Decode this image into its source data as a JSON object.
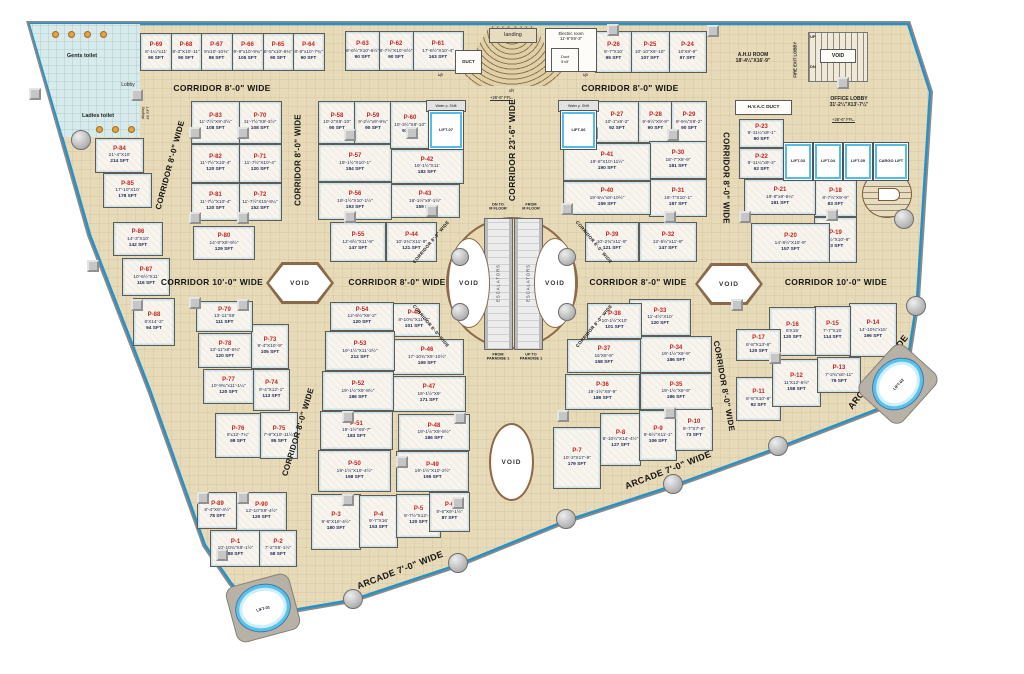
{
  "colors": {
    "floor": "#e7dab8",
    "outline_blue": "#2792c8",
    "unit_fill": "#f8f4ee",
    "unit_label_red": "#c22621",
    "unit_label_navy": "#1b2a56",
    "void_border": "#8a6a4a",
    "toilet_fill": "#d7ebec",
    "lift_blue": "#54bce6"
  },
  "rooms": {
    "gents_toilet": "Gents toilet",
    "ladies_toilet": "Ladies toilet",
    "lobby": "Lobby",
    "display": "display\n46 SFT",
    "duct": "DUCT",
    "landing": "landing",
    "electric_room": "Electric room\n11'-9\"X9'-3\"",
    "duct_small": "Duct\n5'x5'",
    "ahu_room": "A.H.U ROOM\n18'-4¼\"X16'-9\"",
    "fire_exit_lobby": "FIRE EXIT LOBBY",
    "stair_void": "VOID",
    "up": "UP",
    "dn": "DN",
    "up_small": "up",
    "dn_small": "dn",
    "office_lobby": "OFFICE LOBBY\n31'-2¼\"X13'-7¼\"",
    "ffl": "+26'-6\" FFL.",
    "hvac_duct": "H.V.A.C DUCT",
    "water_shaft": "Water p. Shift"
  },
  "escalators": {
    "label": "ESCALATORS",
    "tl": "DN TO\nM FLOOR",
    "tr": "FROM\nM FLOOR",
    "bl": "FROM\nPARADISE 1",
    "br": "UP TO\nPARADISE 1"
  },
  "corridor_labels": [
    {
      "t": "CORRIDOR 8'-0\" WIDE",
      "x": 222,
      "y": 88,
      "r": 0,
      "s": 8.5
    },
    {
      "t": "CORRIDOR 8'-0\" WIDE",
      "x": 630,
      "y": 88,
      "r": 0,
      "s": 8.5
    },
    {
      "t": "CORRIDOR 8'-0\" WIDE",
      "x": 170,
      "y": 165,
      "r": -75,
      "s": 8
    },
    {
      "t": "CORRIDOR 8'-0\" WIDE",
      "x": 298,
      "y": 160,
      "r": -90,
      "s": 8
    },
    {
      "t": "CORRIDOR 23'-6\" WIDE",
      "x": 512,
      "y": 150,
      "r": -90,
      "s": 8.5
    },
    {
      "t": "CORRIDOR 8'-0\" WIDE",
      "x": 726,
      "y": 178,
      "r": 90,
      "s": 8
    },
    {
      "t": "CORRIDOR 10'-0\" WIDE",
      "x": 212,
      "y": 282,
      "r": 0,
      "s": 8.5
    },
    {
      "t": "CORRIDOR 8'-0\" WIDE",
      "x": 397,
      "y": 282,
      "r": 0,
      "s": 8.5
    },
    {
      "t": "CORRIDOR 8'-0\" WIDE",
      "x": 638,
      "y": 282,
      "r": 0,
      "s": 8.5
    },
    {
      "t": "CORRIDOR 10'-0\" WIDE",
      "x": 836,
      "y": 282,
      "r": 0,
      "s": 8.5
    },
    {
      "t": "CORRIDOR 8'-0\" WIDE",
      "x": 298,
      "y": 432,
      "r": -73,
      "s": 8
    },
    {
      "t": "CORRIDOR 8'-0\" WIDE",
      "x": 724,
      "y": 386,
      "r": 80,
      "s": 8
    },
    {
      "t": "ARCADE 7'-0\" WIDE",
      "x": 400,
      "y": 570,
      "r": -21,
      "s": 9
    },
    {
      "t": "ARCADE 7'-0\" WIDE",
      "x": 668,
      "y": 470,
      "r": -21,
      "s": 9
    },
    {
      "t": "ARCADE 7'-0\" WIDE",
      "x": 878,
      "y": 372,
      "r": -52,
      "s": 9
    },
    {
      "t": "CORRIDOR 8'-0\" WIDE",
      "x": 431,
      "y": 242,
      "r": -50,
      "s": 4.5
    },
    {
      "t": "CORRIDOR 8'-0\" WIDE",
      "x": 594,
      "y": 242,
      "r": 50,
      "s": 4.5
    },
    {
      "t": "CORRIDOR 8'-0\" WIDE",
      "x": 431,
      "y": 326,
      "r": 50,
      "s": 4.5
    },
    {
      "t": "CORRIDOR 8'-0\" WIDE",
      "x": 594,
      "y": 326,
      "r": -50,
      "s": 4.5
    }
  ],
  "voids": [
    {
      "label": "VOID",
      "type": "hex",
      "x": 266,
      "y": 262,
      "w": 68,
      "h": 42
    },
    {
      "label": "VOID",
      "type": "hex",
      "x": 695,
      "y": 263,
      "w": 68,
      "h": 42
    },
    {
      "label": "VOID",
      "type": "ellipse",
      "x": 489,
      "y": 423,
      "w": 45,
      "h": 78
    },
    {
      "label": "VOID",
      "type": "lens",
      "x": 448,
      "y": 238,
      "w": 42,
      "h": 90
    },
    {
      "label": "VOID",
      "type": "lens",
      "x": 534,
      "y": 238,
      "w": 42,
      "h": 90
    }
  ],
  "lifts": [
    {
      "id": "LIFT-07",
      "x": 428,
      "y": 110,
      "w": 34,
      "h": 38,
      "round": false,
      "r": 0
    },
    {
      "id": "LIFT-06",
      "x": 560,
      "y": 110,
      "w": 35,
      "h": 38,
      "round": false,
      "r": 0
    },
    {
      "id": "LIFT-03",
      "x": 783,
      "y": 142,
      "w": 28,
      "h": 37,
      "round": false,
      "r": 0
    },
    {
      "id": "LIFT-04",
      "x": 813,
      "y": 142,
      "w": 28,
      "h": 37,
      "round": false,
      "r": 0
    },
    {
      "id": "LIFT-05",
      "x": 843,
      "y": 142,
      "w": 28,
      "h": 37,
      "round": false,
      "r": 0
    },
    {
      "id": "CARGO LIFT",
      "x": 873,
      "y": 142,
      "w": 34,
      "h": 37,
      "round": false,
      "r": 0
    },
    {
      "id": "LIFT-01",
      "x": 235,
      "y": 584,
      "w": 54,
      "h": 46,
      "round": true,
      "r": -15
    },
    {
      "id": "LIFT-02",
      "x": 870,
      "y": 360,
      "w": 54,
      "h": 46,
      "round": true,
      "r": -48
    }
  ],
  "columns": [
    [
      35,
      94
    ],
    [
      137,
      95
    ],
    [
      195,
      133
    ],
    [
      243,
      133
    ],
    [
      195,
      218
    ],
    [
      243,
      218
    ],
    [
      93,
      266
    ],
    [
      137,
      305
    ],
    [
      195,
      303
    ],
    [
      243,
      305
    ],
    [
      203,
      498
    ],
    [
      243,
      498
    ],
    [
      222,
      555
    ],
    [
      350,
      135
    ],
    [
      350,
      217
    ],
    [
      412,
      133
    ],
    [
      432,
      211
    ],
    [
      567,
      209
    ],
    [
      592,
      133
    ],
    [
      673,
      135
    ],
    [
      670,
      217
    ],
    [
      745,
      217
    ],
    [
      832,
      215
    ],
    [
      737,
      305
    ],
    [
      775,
      358
    ],
    [
      348,
      417
    ],
    [
      348,
      500
    ],
    [
      460,
      418
    ],
    [
      458,
      503
    ],
    [
      563,
      416
    ],
    [
      670,
      413
    ],
    [
      613,
      30
    ],
    [
      713,
      31
    ],
    [
      843,
      83
    ],
    [
      402,
      462
    ]
  ],
  "edge_dots": [
    [
      903,
      218
    ],
    [
      915,
      305
    ],
    [
      777,
      445
    ],
    [
      672,
      483
    ],
    [
      565,
      518
    ],
    [
      457,
      562
    ],
    [
      352,
      598
    ],
    [
      80,
      139
    ]
  ],
  "ring_dots": [
    [
      459,
      256
    ],
    [
      566,
      256
    ],
    [
      459,
      311
    ],
    [
      566,
      311
    ]
  ],
  "units": [
    {
      "id": "P-1",
      "dim": "10'-10¾\"X8'-1½\"",
      "sft": "88 SFT",
      "x": 210,
      "y": 530,
      "w": 49,
      "h": 35
    },
    {
      "id": "P-2",
      "dim": "7'-2\"X8'-1½\"",
      "sft": "58 SFT",
      "x": 259,
      "y": 530,
      "w": 36,
      "h": 35
    },
    {
      "id": "P-3",
      "dim": "9'-6\"X19'-4½\"",
      "sft": "180 SFT",
      "x": 311,
      "y": 494,
      "w": 48,
      "h": 54
    },
    {
      "id": "P-4",
      "dim": "9'-7\"X16'",
      "sft": "153 SFT",
      "x": 359,
      "y": 495,
      "w": 37,
      "h": 51
    },
    {
      "id": "P-5",
      "dim": "9'-7½\"X12'-6\"",
      "sft": "120 SFT",
      "x": 396,
      "y": 494,
      "w": 43,
      "h": 42
    },
    {
      "id": "P-6",
      "dim": "9'-6\"X9'-1½\"",
      "sft": "87 SFT",
      "x": 429,
      "y": 492,
      "w": 39,
      "h": 38
    },
    {
      "id": "P-7",
      "dim": "10'-3\"X17'-9\"",
      "sft": "179 SFT",
      "x": 553,
      "y": 427,
      "w": 46,
      "h": 60
    },
    {
      "id": "P-8",
      "dim": "8'-10½\"X14'-4½\"",
      "sft": "127 SFT",
      "x": 600,
      "y": 413,
      "w": 39,
      "h": 51
    },
    {
      "id": "P-9",
      "dim": "9'-6½\"X11'-1\"",
      "sft": "106 SFT",
      "x": 639,
      "y": 410,
      "w": 36,
      "h": 49
    },
    {
      "id": "P-10",
      "dim": "9'-7\"X7'-8\"",
      "sft": "73 SFT",
      "x": 675,
      "y": 407,
      "w": 36,
      "h": 42
    },
    {
      "id": "P-11",
      "dim": "8'-8\"X10'-8\"",
      "sft": "92 SFT",
      "x": 736,
      "y": 377,
      "w": 43,
      "h": 42
    },
    {
      "id": "P-12",
      "dim": "11'X12'-8½\"",
      "sft": "158 SFT",
      "x": 772,
      "y": 359,
      "w": 47,
      "h": 46
    },
    {
      "id": "P-13",
      "dim": "7'-2¾\"x8'-11\"",
      "sft": "76 SFT",
      "x": 817,
      "y": 357,
      "w": 42,
      "h": 34
    },
    {
      "id": "P-14",
      "dim": "14'-10¾\"x15'",
      "sft": "196 SFT",
      "x": 849,
      "y": 303,
      "w": 46,
      "h": 52
    },
    {
      "id": "P-15",
      "dim": "7'-7\"X15'",
      "sft": "114 SFT",
      "x": 814,
      "y": 306,
      "w": 35,
      "h": 48
    },
    {
      "id": "P-16",
      "dim": "8'X15'",
      "sft": "120 SFT",
      "x": 769,
      "y": 307,
      "w": 45,
      "h": 47
    },
    {
      "id": "P-17",
      "dim": "8'-8\"X13'-6\"",
      "sft": "120 SFT",
      "x": 736,
      "y": 329,
      "w": 43,
      "h": 30
    },
    {
      "id": "P-18",
      "dim": "8'-7½\"X9'-9\"",
      "sft": "83 SFT",
      "x": 814,
      "y": 179,
      "w": 41,
      "h": 36
    },
    {
      "id": "P-19",
      "dim": "8'-8½\"X10'-9\"",
      "sft": "93 SFT",
      "x": 814,
      "y": 217,
      "w": 41,
      "h": 44
    },
    {
      "id": "P-20",
      "dim": "14'-8½\"X10'-9\"",
      "sft": "157 SFT",
      "x": 751,
      "y": 223,
      "w": 77,
      "h": 38
    },
    {
      "id": "P-21",
      "dim": "18'-8\"x9'-8¼\"",
      "sft": "181 SFT",
      "x": 744,
      "y": 179,
      "w": 70,
      "h": 34
    },
    {
      "id": "P-22",
      "dim": "9'-11¼\"x9'-3\"",
      "sft": "92 SFT",
      "x": 739,
      "y": 148,
      "w": 43,
      "h": 29
    },
    {
      "id": "P-23",
      "dim": "9'-11¼\"x9'-1\"",
      "sft": "90 SFT",
      "x": 739,
      "y": 119,
      "w": 43,
      "h": 27
    },
    {
      "id": "P-24",
      "dim": "10'X9'-9\"",
      "sft": "97 SFT",
      "x": 668,
      "y": 31,
      "w": 37,
      "h": 40
    },
    {
      "id": "P-25",
      "dim": "10'-10\"X9'-10\"",
      "sft": "107 SFT",
      "x": 630,
      "y": 31,
      "w": 38,
      "h": 40
    },
    {
      "id": "P-26",
      "dim": "9'-7\"X10'",
      "sft": "95 SFT",
      "x": 595,
      "y": 31,
      "w": 35,
      "h": 40
    },
    {
      "id": "P-27",
      "dim": "10'-1\"x9'-2\"",
      "sft": "92 SFT",
      "x": 594,
      "y": 101,
      "w": 44,
      "h": 40
    },
    {
      "id": "P-28",
      "dim": "9'-9½\"X9'-9\"",
      "sft": "90 SFT",
      "x": 638,
      "y": 101,
      "w": 33,
      "h": 40
    },
    {
      "id": "P-29",
      "dim": "9'-9¾\"X9'-2\"",
      "sft": "90 SFT",
      "x": 671,
      "y": 101,
      "w": 34,
      "h": 40
    },
    {
      "id": "P-30",
      "dim": "18'-7\"X9'-9\"",
      "sft": "181 SFT",
      "x": 649,
      "y": 141,
      "w": 56,
      "h": 36
    },
    {
      "id": "P-31",
      "dim": "18'-7\"X10'-1\"",
      "sft": "187 SFT",
      "x": 649,
      "y": 179,
      "w": 56,
      "h": 36
    },
    {
      "id": "P-32",
      "dim": "12'-6½\"x11'-9\"",
      "sft": "147 SFT",
      "x": 639,
      "y": 222,
      "w": 56,
      "h": 38
    },
    {
      "id": "P-33",
      "dim": "11'-4½\"X10'",
      "sft": "120 SFT",
      "x": 629,
      "y": 299,
      "w": 60,
      "h": 35
    },
    {
      "id": "P-34",
      "dim": "19'-1½\"X9'-9\"",
      "sft": "186 SFT",
      "x": 640,
      "y": 336,
      "w": 70,
      "h": 35
    },
    {
      "id": "P-35",
      "dim": "19'-1½\"X9'-9\"",
      "sft": "186 SFT",
      "x": 640,
      "y": 373,
      "w": 70,
      "h": 35
    },
    {
      "id": "P-36",
      "dim": "19'-1½\"X9'-9\"",
      "sft": "186 SFT",
      "x": 565,
      "y": 374,
      "w": 73,
      "h": 34
    },
    {
      "id": "P-37",
      "dim": "16'X9'-9\"",
      "sft": "158 SFT",
      "x": 567,
      "y": 339,
      "w": 72,
      "h": 32
    },
    {
      "id": "P-38",
      "dim": "10'-1½\"X10'",
      "sft": "101 SFT",
      "x": 587,
      "y": 303,
      "w": 53,
      "h": 34
    },
    {
      "id": "P-39",
      "dim": "10'-2¾\"x11'-9\"",
      "sft": "121 SFT",
      "x": 585,
      "y": 222,
      "w": 52,
      "h": 38
    },
    {
      "id": "P-40",
      "dim": "19'-5¼\"x8'-10½\"",
      "sft": "159 SFT",
      "x": 563,
      "y": 181,
      "w": 86,
      "h": 32
    },
    {
      "id": "P-41",
      "dim": "19'-6\"X10'-11½\"",
      "sft": "190 SFT",
      "x": 563,
      "y": 143,
      "w": 86,
      "h": 36
    },
    {
      "id": "P-42",
      "dim": "19'-1½\"X11'",
      "sft": "182 SFT",
      "x": 390,
      "y": 149,
      "w": 72,
      "h": 33
    },
    {
      "id": "P-43",
      "dim": "18'-1½\"x9'-1½\"",
      "sft": "159 SFT",
      "x": 390,
      "y": 184,
      "w": 68,
      "h": 32
    },
    {
      "id": "P-44",
      "dim": "10'-2¾\"X11'-9\"",
      "sft": "121 SFT",
      "x": 386,
      "y": 222,
      "w": 49,
      "h": 38
    },
    {
      "id": "P-45",
      "dim": "8'-10¾\"X11'-3\"",
      "sft": "101 SFT",
      "x": 388,
      "y": 303,
      "w": 50,
      "h": 32
    },
    {
      "id": "P-46",
      "dim": "17'-10¾\"X9'-10½\"",
      "sft": "169 SFT",
      "x": 390,
      "y": 339,
      "w": 72,
      "h": 34
    },
    {
      "id": "P-47",
      "dim": "19'-1½\"X9'",
      "sft": "171 SFT",
      "x": 392,
      "y": 376,
      "w": 72,
      "h": 34
    },
    {
      "id": "P-48",
      "dim": "19'-1½\"X9'-8½\"",
      "sft": "186 SFT",
      "x": 398,
      "y": 414,
      "w": 70,
      "h": 35
    },
    {
      "id": "P-49",
      "dim": "19'-1½\"X10'-2½\"",
      "sft": "195 SFT",
      "x": 396,
      "y": 451,
      "w": 71,
      "h": 39
    },
    {
      "id": "P-50",
      "dim": "19'-1½\"X10'-4½\"",
      "sft": "198 SFT",
      "x": 318,
      "y": 450,
      "w": 71,
      "h": 40
    },
    {
      "id": "P-51",
      "dim": "19'-1½\"X9'-7\"",
      "sft": "183 SFT",
      "x": 320,
      "y": 411,
      "w": 71,
      "h": 37
    },
    {
      "id": "P-52",
      "dim": "19'-1½\"X9'-8½\"",
      "sft": "186 SFT",
      "x": 322,
      "y": 371,
      "w": 70,
      "h": 38
    },
    {
      "id": "P-53",
      "dim": "19'-1½\"X11'-2½\"",
      "sft": "212 SFT",
      "x": 325,
      "y": 331,
      "w": 68,
      "h": 38
    },
    {
      "id": "P-54",
      "dim": "12'-5½\"X9'-2\"",
      "sft": "120 SFT",
      "x": 330,
      "y": 302,
      "w": 62,
      "h": 27
    },
    {
      "id": "P-55",
      "dim": "12'-6½\"X11'-9\"",
      "sft": "147 SFT",
      "x": 330,
      "y": 222,
      "w": 54,
      "h": 38
    },
    {
      "id": "P-56",
      "dim": "19'-1½\"X10'-1½\"",
      "sft": "193 SFT",
      "x": 318,
      "y": 182,
      "w": 72,
      "h": 36
    },
    {
      "id": "P-57",
      "dim": "19'-1½\"X10'-1\"",
      "sft": "184 SFT",
      "x": 318,
      "y": 144,
      "w": 72,
      "h": 36
    },
    {
      "id": "P-58",
      "dim": "10'-2\"X8'-10\"",
      "sft": "90 SFT",
      "x": 318,
      "y": 101,
      "w": 36,
      "h": 41
    },
    {
      "id": "P-59",
      "dim": "9'-2½\"x9'-9¾\"",
      "sft": "90 SFT",
      "x": 354,
      "y": 101,
      "w": 36,
      "h": 41
    },
    {
      "id": "P-60",
      "dim": "10'-3½\"X8'-10\"",
      "sft": "91 SFT",
      "x": 390,
      "y": 101,
      "w": 38,
      "h": 46
    },
    {
      "id": "P-61",
      "dim": "17'-8½\"X10'-4\"",
      "sft": "163 SFT",
      "x": 412,
      "y": 31,
      "w": 50,
      "h": 38
    },
    {
      "id": "P-62",
      "dim": "8'-7½\"X10'-5½\"",
      "sft": "90 SFT",
      "x": 378,
      "y": 31,
      "w": 34,
      "h": 38
    },
    {
      "id": "P-63",
      "dim": "8'-6½\"X10'-6½\"",
      "sft": "90 SFT",
      "x": 345,
      "y": 31,
      "w": 33,
      "h": 38
    },
    {
      "id": "P-64",
      "dim": "8'-6\"x10'-7¾\"",
      "sft": "90 SFT",
      "x": 292,
      "y": 33,
      "w": 31,
      "h": 36
    },
    {
      "id": "P-65",
      "dim": "8'-5\"x10'-8¾\"",
      "sft": "90 SFT",
      "x": 262,
      "y": 33,
      "w": 30,
      "h": 36
    },
    {
      "id": "P-66",
      "dim": "9'-9\"x10'-9¾\"",
      "sft": "105 SFT",
      "x": 231,
      "y": 33,
      "w": 31,
      "h": 36
    },
    {
      "id": "P-67",
      "dim": "9'x10'-10¾\"",
      "sft": "98 SFT",
      "x": 200,
      "y": 33,
      "w": 31,
      "h": 36
    },
    {
      "id": "P-68",
      "dim": "8'-3\"X10'-11\"",
      "sft": "90 SFT",
      "x": 170,
      "y": 33,
      "w": 30,
      "h": 36
    },
    {
      "id": "P-69",
      "dim": "8'-1¼\"x11'",
      "sft": "90 SFT",
      "x": 140,
      "y": 33,
      "w": 30,
      "h": 36
    },
    {
      "id": "P-70",
      "dim": "11'-7½\"X9'-3½\"",
      "sft": "108 SFT",
      "x": 238,
      "y": 101,
      "w": 42,
      "h": 41
    },
    {
      "id": "P-71",
      "dim": "11'-7½\"X10'-4\"",
      "sft": "120 SFT",
      "x": 238,
      "y": 144,
      "w": 42,
      "h": 37
    },
    {
      "id": "P-72",
      "dim": "11'-7½\"X15'-8¼\"",
      "sft": "152 SFT",
      "x": 238,
      "y": 183,
      "w": 42,
      "h": 36
    },
    {
      "id": "P-73",
      "dim": "9'-4\"X10'-9\"",
      "sft": "105 SFT",
      "x": 251,
      "y": 324,
      "w": 36,
      "h": 43
    },
    {
      "id": "P-74",
      "dim": "9'-4\"X12'-1\"",
      "sft": "113 SFT",
      "x": 253,
      "y": 369,
      "w": 35,
      "h": 40
    },
    {
      "id": "P-75",
      "dim": "7'-9\"X10'-11½\"",
      "sft": "85 SFT",
      "x": 260,
      "y": 412,
      "w": 36,
      "h": 45
    },
    {
      "id": "P-76",
      "dim": "8'x12'-7¼\"",
      "sft": "98 SFT",
      "x": 215,
      "y": 413,
      "w": 44,
      "h": 43
    },
    {
      "id": "P-77",
      "dim": "10'-9¾\"x11'-1¼\"",
      "sft": "120 SFT",
      "x": 203,
      "y": 369,
      "w": 49,
      "h": 33
    },
    {
      "id": "P-78",
      "dim": "13'-11\"x8'-8¾\"",
      "sft": "120 SFT",
      "x": 198,
      "y": 333,
      "w": 52,
      "h": 33
    },
    {
      "id": "P-79",
      "dim": "13'-11\"X8'",
      "sft": "111 SFT",
      "x": 196,
      "y": 301,
      "w": 55,
      "h": 29
    },
    {
      "id": "P-80",
      "dim": "14'-9\"X8'-9½\"",
      "sft": "129 SFT",
      "x": 193,
      "y": 226,
      "w": 60,
      "h": 32
    },
    {
      "id": "P-81",
      "dim": "11'-7½\"X10'-4\"",
      "sft": "120 SFT",
      "x": 191,
      "y": 183,
      "w": 47,
      "h": 36
    },
    {
      "id": "P-82",
      "dim": "11'-7½\"X10'-4\"",
      "sft": "120 SFT",
      "x": 191,
      "y": 144,
      "w": 47,
      "h": 37
    },
    {
      "id": "P-83",
      "dim": "11'-7½\"X9'-3½\"",
      "sft": "108 SFT",
      "x": 191,
      "y": 101,
      "w": 47,
      "h": 41
    },
    {
      "id": "P-84",
      "dim": "21'-4\"X10'",
      "sft": "214 SFT",
      "x": 95,
      "y": 138,
      "w": 47,
      "h": 33
    },
    {
      "id": "P-85",
      "dim": "17'-10\"X10'",
      "sft": "178 SFT",
      "x": 103,
      "y": 173,
      "w": 47,
      "h": 33
    },
    {
      "id": "P-86",
      "dim": "14'-3\"X10'",
      "sft": "142 SFT",
      "x": 113,
      "y": 222,
      "w": 48,
      "h": 32
    },
    {
      "id": "P-87",
      "dim": "10'-6½\"X11'",
      "sft": "116 SFT",
      "x": 122,
      "y": 258,
      "w": 46,
      "h": 36
    },
    {
      "id": "P-88",
      "dim": "6'X14'-2\"",
      "sft": "94 SFT",
      "x": 133,
      "y": 298,
      "w": 40,
      "h": 46
    },
    {
      "id": "P-89",
      "dim": "8'-4\"X9'-4½\"",
      "sft": "78 SFT",
      "x": 197,
      "y": 492,
      "w": 39,
      "h": 35
    },
    {
      "id": "P-90",
      "dim": "12'-10\"X9'-4½\"",
      "sft": "120 SFT",
      "x": 236,
      "y": 492,
      "w": 49,
      "h": 37
    }
  ]
}
